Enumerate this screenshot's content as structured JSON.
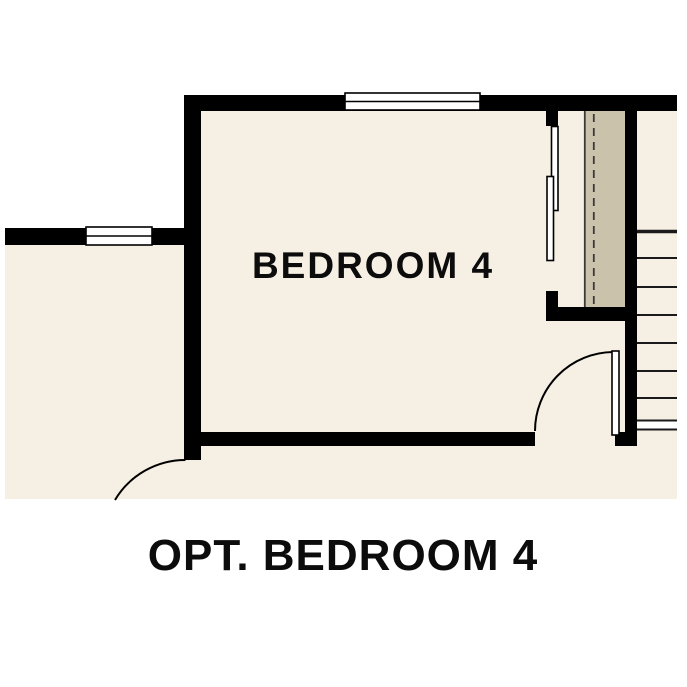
{
  "plan": {
    "room_label": "BEDROOM 4",
    "caption": "OPT. BEDROOM 4"
  },
  "colors": {
    "background": "#ffffff",
    "floor": "#f6efe4",
    "stair-chase": "#cbc2ac",
    "wall": "#000000",
    "line": "#1a1a1a"
  }
}
